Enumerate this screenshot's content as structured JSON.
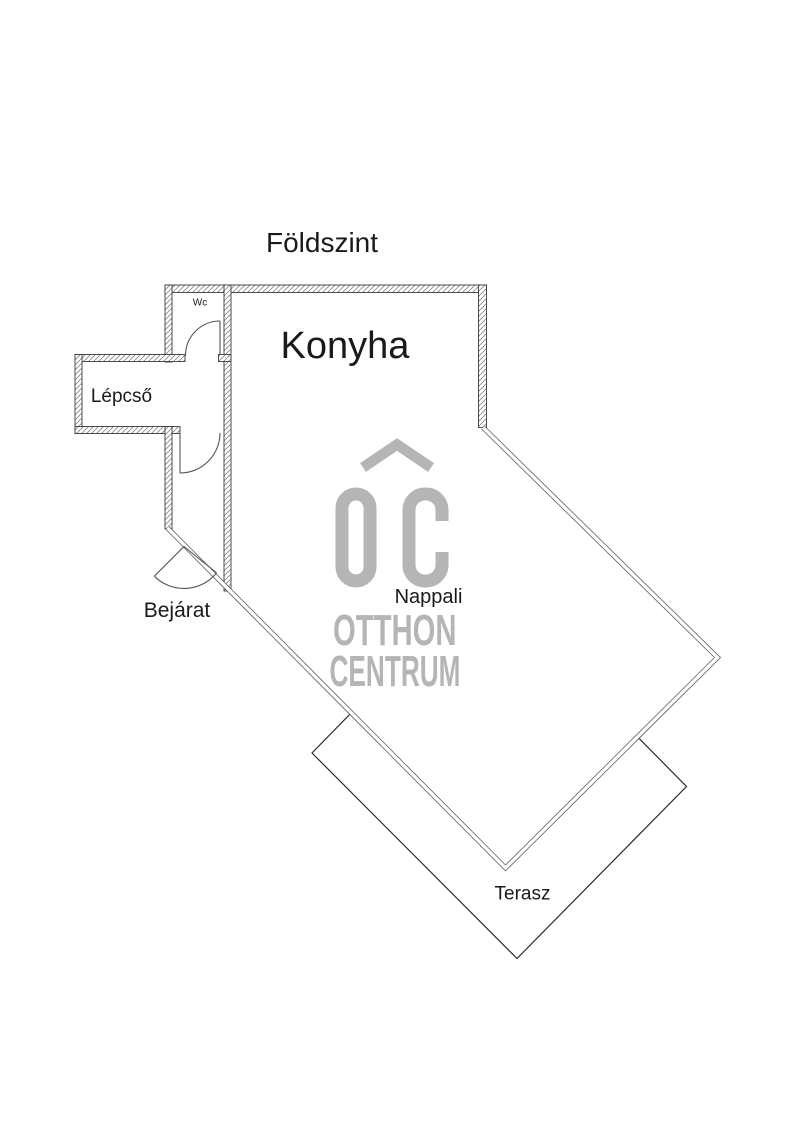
{
  "title": "Földszint",
  "rooms": {
    "wc": {
      "label": "Wc"
    },
    "konyha": {
      "label": "Konyha"
    },
    "lepcso": {
      "label": "Lépcső"
    },
    "bejarat": {
      "label": "Bejárat"
    },
    "nappali": {
      "label": "Nappali"
    },
    "terasz": {
      "label": "Terasz"
    }
  },
  "watermark": {
    "logo": "OC",
    "line1": "OTTHON",
    "line2": "CENTRUM"
  },
  "colors": {
    "background": "#ffffff",
    "wall_outline": "#3a3a3a",
    "wall_hatch": "#8a8a8a",
    "thin_wall_line": "#5f5f5f",
    "terrace_line": "#2b2b2b",
    "door_arc": "#555555",
    "label_text": "#1a1a1a",
    "watermark_gray": "#b5b5b5"
  }
}
